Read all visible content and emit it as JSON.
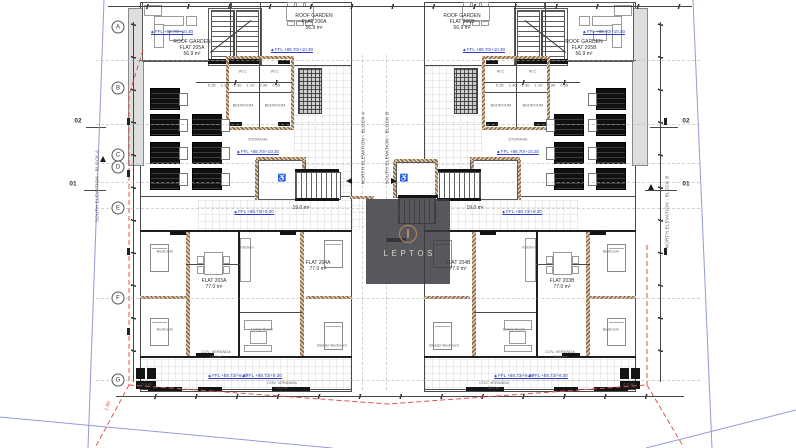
{
  "watermark": {
    "brand": "LEPTOS"
  },
  "grid_rows": [
    "A",
    "B",
    "C",
    "D",
    "E",
    "F",
    "G"
  ],
  "sections": {
    "s02": "02",
    "s01": "01"
  },
  "elevations": {
    "left": "SOUTH ELEVATION - BLOCK A",
    "right": "NORTH ELEVATION - BLOCK B",
    "center_a": "NORTH ELEVATION - BLOCK A",
    "center_b": "SOUTH ELEVATION - BLOCK B"
  },
  "levels": {
    "roof": "FFL +88.70/+10.30",
    "floor": "FFL +88.73/+9.30"
  },
  "areas": {
    "lobby": "19.0 m²",
    "small": "6.3 m²"
  },
  "dims": {
    "red": "1.80",
    "row": "5.35 1.30 2.30 1.10 2.30 0.55"
  },
  "icons": {
    "wheelchair": "♿",
    "level_diamond": "◆"
  },
  "rooms": {
    "wc": "W.C.",
    "bedroom": "BEDROOM",
    "storage": "STORAGE",
    "kitchen": "Kitchen",
    "living": "Living Room",
    "master": "Master Bedroom",
    "bed": "Bedroom",
    "veranda_l1": "COV. VERANDA",
    "veranda_l2": "15.0 m²"
  },
  "block_a": {
    "rg_west_l1": "ROOF GARDEN",
    "rg_west_l2": "FLAT 205A",
    "rg_west_l3": "56.9 m²",
    "rg_east_l1": "ROOF GARDEN",
    "rg_east_l2": "FLAT 206A",
    "rg_east_l3": "56.9 m²",
    "flat_w_l1": "FLAT 203A",
    "flat_w_l2": "77.0 m²",
    "flat_e_l1": "FLAT 204A",
    "flat_e_l2": "77.0 m²"
  },
  "block_b": {
    "rg_west_l1": "ROOF GARDEN",
    "rg_west_l2": "FLAT 206B",
    "rg_west_l3": "56.9 m²",
    "rg_east_l1": "ROOF GARDEN",
    "rg_east_l2": "FLAT 205B",
    "rg_east_l3": "56.9 m²",
    "flat_w_l1": "FLAT 204B",
    "flat_w_l2": "77.0 m²",
    "flat_e_l1": "FLAT 203B",
    "flat_e_l2": "77.0 m²"
  }
}
